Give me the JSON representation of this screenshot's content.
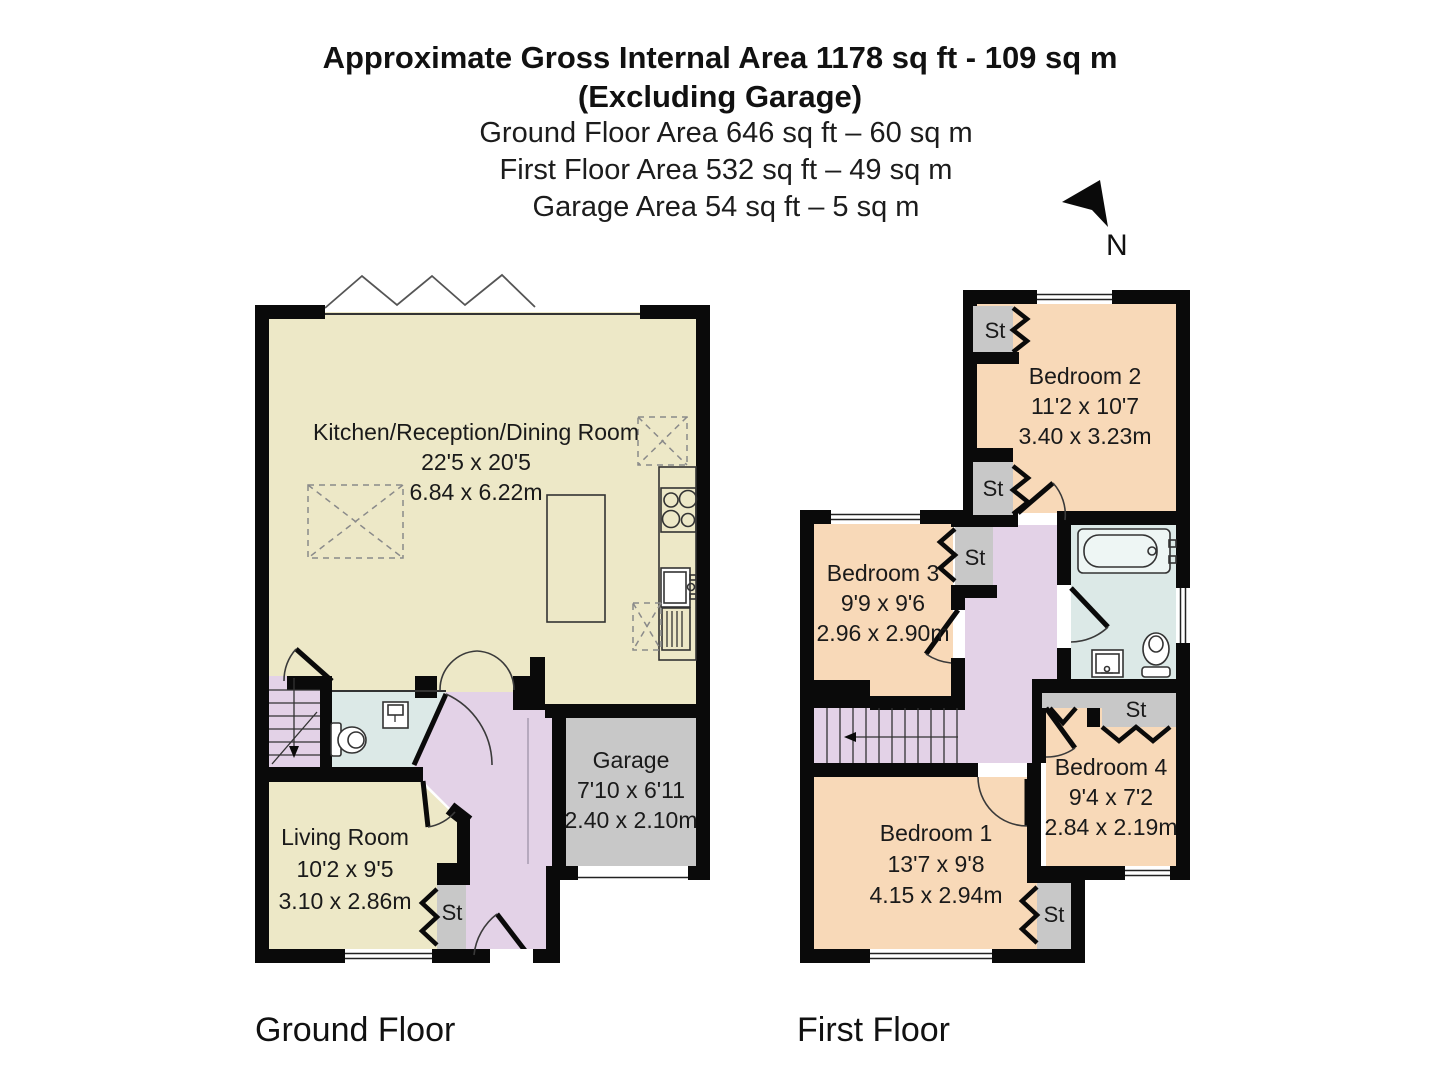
{
  "header": {
    "title_line1": "Approximate Gross Internal Area 1178 sq ft - 109 sq m",
    "title_line2": "(Excluding Garage)",
    "ground_area": "Ground Floor Area 646 sq ft – 60 sq m",
    "first_area": "First Floor Area 532 sq ft – 49 sq m",
    "garage_area": "Garage Area 54 sq ft – 5 sq m",
    "north_label": "N"
  },
  "ground_floor": {
    "label": "Ground Floor",
    "kitchen": {
      "name": "Kitchen/Reception/Dining Room",
      "imperial": "22'5 x 20'5",
      "metric": "6.84 x 6.22m"
    },
    "living_room": {
      "name": "Living Room",
      "imperial": "10'2 x 9'5",
      "metric": "3.10 x 2.86m"
    },
    "garage": {
      "name": "Garage",
      "imperial": "7'10 x 6'11",
      "metric": "2.40 x 2.10m"
    },
    "storage": "St"
  },
  "first_floor": {
    "label": "First Floor",
    "bedroom1": {
      "name": "Bedroom 1",
      "imperial": "13'7 x 9'8",
      "metric": "4.15 x 2.94m"
    },
    "bedroom2": {
      "name": "Bedroom 2",
      "imperial": "11'2 x 10'7",
      "metric": "3.40 x 3.23m"
    },
    "bedroom3": {
      "name": "Bedroom 3",
      "imperial": "9'9 x 9'6",
      "metric": "2.96 x 2.90m"
    },
    "bedroom4": {
      "name": "Bedroom 4",
      "imperial": "9'4 x 7'2",
      "metric": "2.84 x 2.19m"
    },
    "storage": "St"
  },
  "colors": {
    "reception_cream": "#EDE8C7",
    "bedroom_peach": "#F8D9B8",
    "hall_purple": "#E3D2E7",
    "bath_blue": "#DCE9E7",
    "storage_gray": "#C8C8C8",
    "wall_black": "#0A0A0A"
  }
}
